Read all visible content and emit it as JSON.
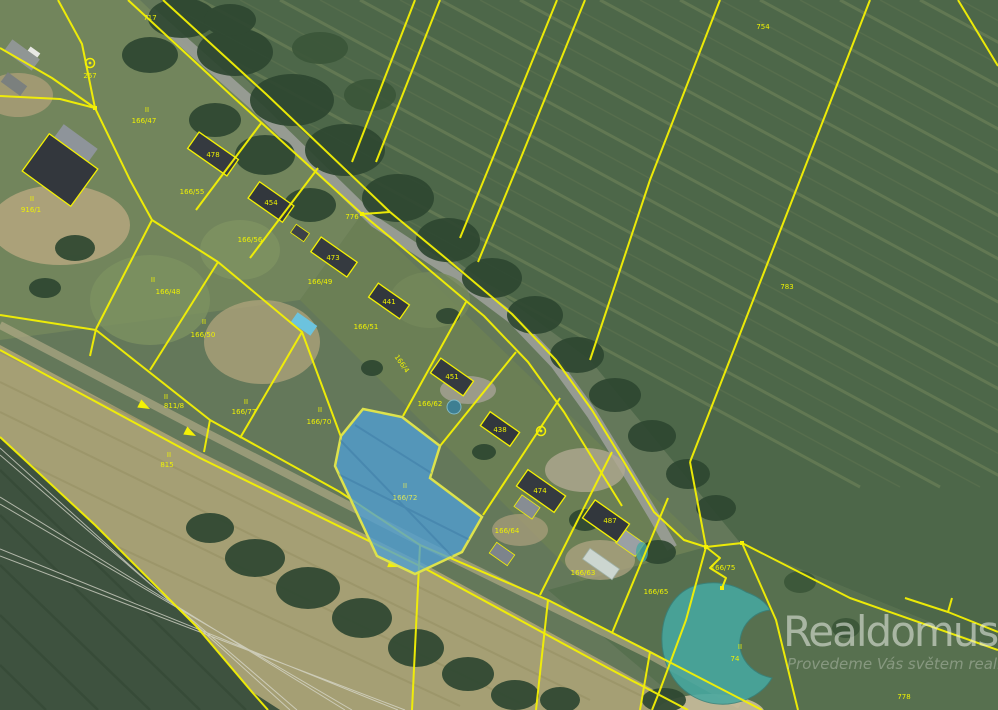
{
  "map": {
    "type": "cadastral-aerial-map",
    "watermark": {
      "brand": "Realdomus",
      "tagline": "Provedeme Vás světem realit"
    },
    "highlight_parcel": {
      "marker": "II",
      "number": "166/72",
      "fill": "#4f9fd4",
      "border": "#dde24c"
    },
    "colors": {
      "parcel_line": "#f4f104",
      "label_text": "#eef103",
      "highlight_fill": "#4f9fd4",
      "water": "#47a8a0",
      "field_dark": "#4d6749",
      "field_tan": "#a59f74"
    },
    "labels": [
      {
        "text": "717"
      },
      {
        "text": "267"
      },
      {
        "text": "II"
      },
      {
        "text": "166/47"
      },
      {
        "text": "478"
      },
      {
        "text": "166/55"
      },
      {
        "text": "II"
      },
      {
        "text": "916/1"
      },
      {
        "text": "454"
      },
      {
        "text": "166/56"
      },
      {
        "text": "776"
      },
      {
        "text": "473"
      },
      {
        "text": "166/49"
      },
      {
        "text": "II"
      },
      {
        "text": "166/48"
      },
      {
        "text": "II"
      },
      {
        "text": "166/50"
      },
      {
        "text": "441"
      },
      {
        "text": "166/51"
      },
      {
        "text": "754"
      },
      {
        "text": "783"
      },
      {
        "text": "451"
      },
      {
        "text": "166/62"
      },
      {
        "text": "438"
      },
      {
        "text": "II"
      },
      {
        "text": "166/70"
      },
      {
        "text": "II"
      },
      {
        "text": "811/8"
      },
      {
        "text": "II"
      },
      {
        "text": "166/77"
      },
      {
        "text": "II"
      },
      {
        "text": "815"
      },
      {
        "text": "474"
      },
      {
        "text": "166/64"
      },
      {
        "text": "487"
      },
      {
        "text": "166/63"
      },
      {
        "text": "166/65"
      },
      {
        "text": "166/75"
      },
      {
        "text": "II"
      },
      {
        "text": "74"
      },
      {
        "text": "778"
      },
      {
        "text": "166/4"
      }
    ]
  }
}
